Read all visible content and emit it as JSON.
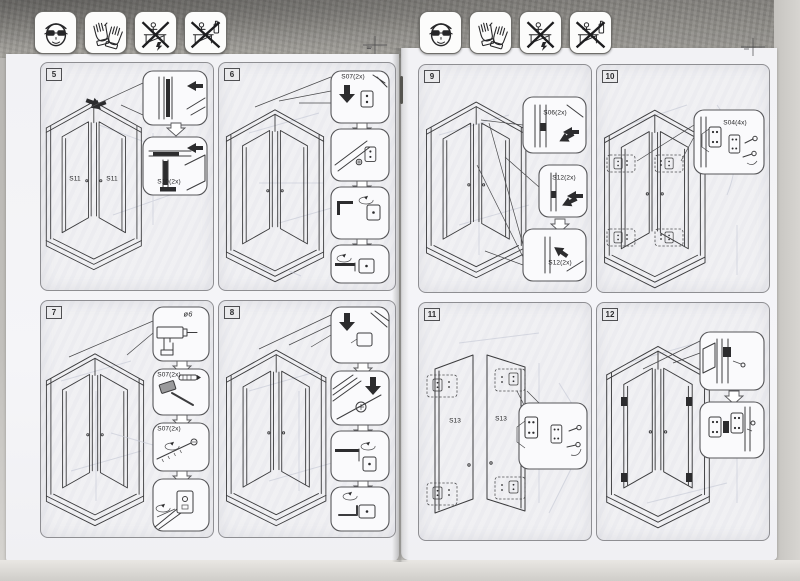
{
  "colors": {
    "paper": "#f4f4f7",
    "panel_fill": "#f0f0f3",
    "line": "#3c3c3e",
    "scanner_top": "#8b8a86",
    "scanner_side": "#d2d0cc"
  },
  "safety_icons": [
    {
      "name": "safety-goggles"
    },
    {
      "name": "protective-gloves"
    },
    {
      "name": "do-not-stand-on-enclosure"
    },
    {
      "name": "do-not-lean-on-enclosure"
    }
  ],
  "pages": [
    {
      "side": "left",
      "panels": [
        {
          "number": "5",
          "labels": {
            "door_left": "S11",
            "door_right": "S11",
            "seal": "S10(2x)"
          }
        },
        {
          "number": "6",
          "labels": {
            "bracket": "S07(2x)"
          }
        },
        {
          "number": "7",
          "labels": {
            "drill": "ø6",
            "plug": "S07(2x)",
            "screw": "S07(2x)"
          }
        },
        {
          "number": "8",
          "labels": {}
        }
      ]
    },
    {
      "side": "right",
      "panels": [
        {
          "number": "9",
          "labels": {
            "top": "S06(2x)",
            "middle": "S12(2x)",
            "bottom": "S12(2x)"
          }
        },
        {
          "number": "10",
          "labels": {
            "hinge": "S04(4x)"
          }
        },
        {
          "number": "11",
          "labels": {
            "door_left": "S13",
            "door_right": "S13"
          }
        },
        {
          "number": "12",
          "labels": {}
        }
      ]
    }
  ]
}
